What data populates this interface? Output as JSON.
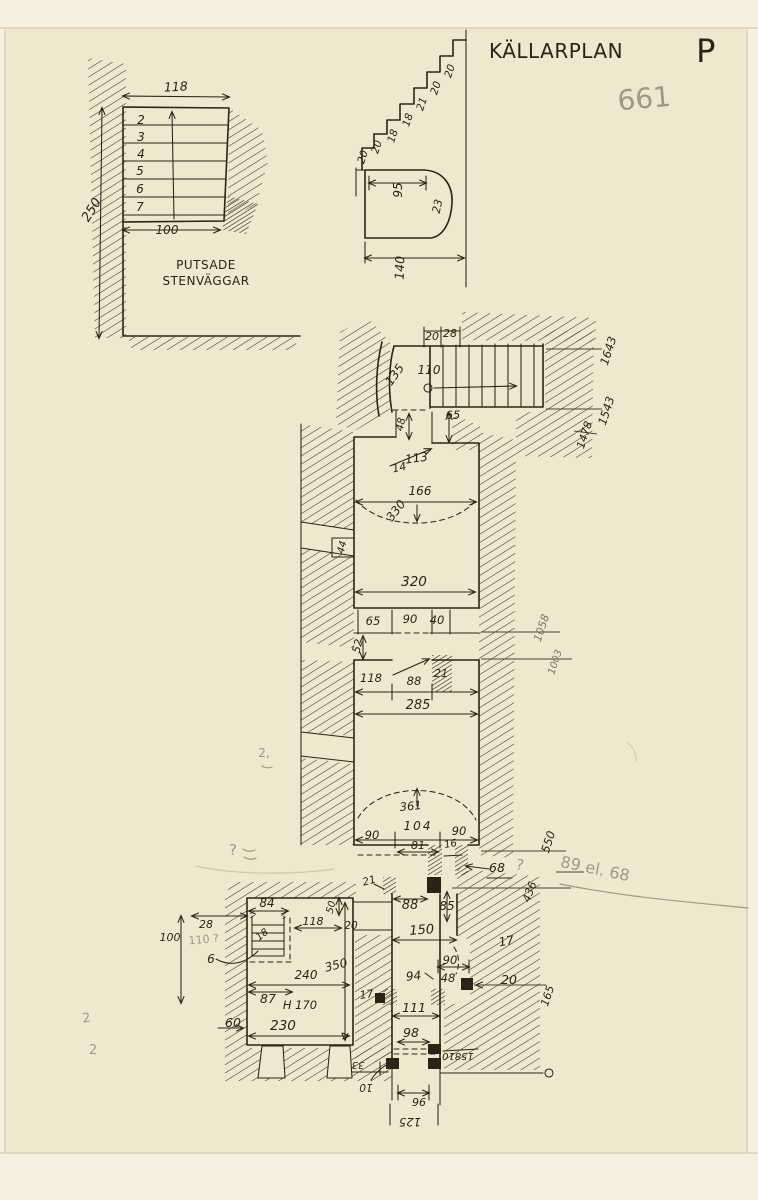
{
  "document": {
    "type": "scanned hand-drawn architectural plan",
    "language": "Swedish"
  },
  "colors": {
    "paper": "#f1e7cf",
    "ink": "#2b2316",
    "pencil": "#a29786"
  },
  "sections": [
    {
      "name": "title-block",
      "labels": [
        {
          "name": "drawing-title",
          "text": "KÄLLARPLAN",
          "x": 556,
          "y": 58,
          "s": 20,
          "sp": 3.5,
          "a": "start",
          "c": "title"
        },
        {
          "name": "drawing-title-plan-letter",
          "text": "P",
          "x": 706,
          "y": 62,
          "s": 32,
          "a": "start",
          "c": "title"
        },
        {
          "name": "archive-number-pencil",
          "text": "661",
          "x": 645,
          "y": 108,
          "s": 28,
          "r": -5,
          "a": "start",
          "c": "pencil"
        }
      ]
    },
    {
      "name": "stair-detail-plan",
      "labels": [
        {
          "name": "dim-width-top",
          "text": "118",
          "x": 176,
          "y": 91,
          "s": 12.5,
          "r": -3
        },
        {
          "name": "step-number",
          "text": "2",
          "x": 141,
          "y": 124,
          "s": 12
        },
        {
          "name": "step-number",
          "text": "3",
          "x": 141,
          "y": 141,
          "s": 12
        },
        {
          "name": "step-number",
          "text": "4",
          "x": 141,
          "y": 158,
          "s": 12
        },
        {
          "name": "step-number",
          "text": "5",
          "x": 140,
          "y": 175,
          "s": 12
        },
        {
          "name": "step-number",
          "text": "6",
          "x": 140,
          "y": 193,
          "s": 12
        },
        {
          "name": "step-number",
          "text": "7",
          "x": 140,
          "y": 211,
          "s": 12
        },
        {
          "name": "dim-height-left",
          "text": "250",
          "x": 95,
          "y": 212,
          "s": 13,
          "r": -58
        },
        {
          "name": "dim-width-bottom",
          "text": "100",
          "x": 167,
          "y": 234,
          "s": 12
        },
        {
          "name": "note-line-1",
          "text": "PUTSADE",
          "x": 206,
          "y": 269,
          "s": 12,
          "sp": 1.5,
          "c": "title"
        },
        {
          "name": "note-line-2",
          "text": "STENVÄGGAR",
          "x": 206,
          "y": 285,
          "s": 12,
          "sp": 1.5,
          "c": "title"
        }
      ]
    },
    {
      "name": "stair-section-detail",
      "labels": [
        {
          "name": "riser-dim",
          "text": "20",
          "x": 453,
          "y": 72,
          "s": 10.5,
          "r": -72
        },
        {
          "name": "riser-dim",
          "text": "20",
          "x": 439,
          "y": 89,
          "s": 10.5,
          "r": -72
        },
        {
          "name": "riser-dim",
          "text": "21",
          "x": 425,
          "y": 105,
          "s": 10.5,
          "r": -72
        },
        {
          "name": "riser-dim",
          "text": "18",
          "x": 411,
          "y": 121,
          "s": 10.5,
          "r": -72
        },
        {
          "name": "riser-dim",
          "text": "18",
          "x": 396,
          "y": 137,
          "s": 10.5,
          "r": -72
        },
        {
          "name": "riser-dim",
          "text": "20",
          "x": 380,
          "y": 148,
          "s": 10.5,
          "r": -72
        },
        {
          "name": "riser-dim",
          "text": "20",
          "x": 366,
          "y": 158,
          "s": 10.5,
          "r": -72
        },
        {
          "name": "arch-width",
          "text": "95",
          "x": 402,
          "y": 190,
          "s": 12,
          "r": -90
        },
        {
          "name": "arch-radius",
          "text": "23",
          "x": 441,
          "y": 207,
          "s": 11,
          "r": -78
        },
        {
          "name": "total-width",
          "text": "140",
          "x": 404,
          "y": 268,
          "s": 12.5,
          "r": -88
        }
      ]
    },
    {
      "name": "upper-stair-flight",
      "labels": [
        {
          "name": "dim",
          "text": "20",
          "x": 432,
          "y": 340,
          "s": 11
        },
        {
          "name": "dim",
          "text": "28",
          "x": 450,
          "y": 337,
          "s": 11
        },
        {
          "name": "dim",
          "text": "135",
          "x": 398,
          "y": 377,
          "s": 12,
          "r": -55
        },
        {
          "name": "dim",
          "text": "110",
          "x": 429,
          "y": 374,
          "s": 12
        },
        {
          "name": "level-mark",
          "text": "1643",
          "x": 612,
          "y": 352,
          "s": 11.5,
          "r": -72
        },
        {
          "name": "level-mark",
          "text": "1543",
          "x": 610,
          "y": 412,
          "s": 11.5,
          "r": -72
        },
        {
          "name": "level-mark",
          "text": "1478",
          "x": 588,
          "y": 436,
          "s": 11,
          "r": -72
        },
        {
          "name": "dim",
          "text": "48",
          "x": 404,
          "y": 425,
          "s": 10.5,
          "r": -78
        },
        {
          "name": "dim",
          "text": "65",
          "x": 453,
          "y": 419,
          "s": 11.5
        },
        {
          "name": "dim",
          "text": "113",
          "x": 417,
          "y": 462,
          "s": 12,
          "r": -8
        },
        {
          "name": "dim",
          "text": "14",
          "x": 400,
          "y": 471,
          "s": 11,
          "r": -12
        }
      ]
    },
    {
      "name": "room-1",
      "labels": [
        {
          "name": "dim",
          "text": "166",
          "x": 420,
          "y": 495,
          "s": 12
        },
        {
          "name": "dim-vault",
          "text": "330",
          "x": 399,
          "y": 513,
          "s": 12,
          "r": -52
        },
        {
          "name": "dim-niche",
          "text": "44",
          "x": 345,
          "y": 548,
          "s": 10,
          "r": -75
        },
        {
          "name": "dim",
          "text": "320",
          "x": 414,
          "y": 586,
          "s": 13.5
        }
      ]
    },
    {
      "name": "door-row",
      "labels": [
        {
          "name": "dim",
          "text": "65",
          "x": 373,
          "y": 625,
          "s": 11.5
        },
        {
          "name": "dim",
          "text": "90",
          "x": 410,
          "y": 623,
          "s": 11.5
        },
        {
          "name": "dim",
          "text": "40",
          "x": 437,
          "y": 624,
          "s": 11.5
        },
        {
          "name": "dim",
          "text": "52",
          "x": 361,
          "y": 647,
          "s": 11,
          "r": -75
        },
        {
          "name": "dim",
          "text": "21",
          "x": 441,
          "y": 677,
          "s": 11
        },
        {
          "name": "dim",
          "text": "118",
          "x": 371,
          "y": 682,
          "s": 11.5
        },
        {
          "name": "dim",
          "text": "88",
          "x": 414,
          "y": 685,
          "s": 11.5
        },
        {
          "name": "dim",
          "text": "285",
          "x": 418,
          "y": 709,
          "s": 13
        },
        {
          "name": "level-mark",
          "text": "1058",
          "x": 545,
          "y": 629,
          "s": 11,
          "r": -72,
          "c": "faint"
        },
        {
          "name": "level-mark",
          "text": "1003",
          "x": 558,
          "y": 663,
          "s": 10,
          "r": -72,
          "c": "faint"
        }
      ]
    },
    {
      "name": "room-2",
      "labels": [
        {
          "name": "dim-vault",
          "text": "361",
          "x": 411,
          "y": 810,
          "s": 11.5,
          "r": -5
        },
        {
          "name": "dim",
          "text": "104",
          "x": 418,
          "y": 830,
          "s": 12,
          "sp": 2
        },
        {
          "name": "dim",
          "text": "90",
          "x": 372,
          "y": 839,
          "s": 11.5
        },
        {
          "name": "dim",
          "text": "90",
          "x": 459,
          "y": 835,
          "s": 11.5
        },
        {
          "name": "dim",
          "text": "81",
          "x": 418,
          "y": 849,
          "s": 11
        },
        {
          "name": "dim",
          "text": "16",
          "x": 451,
          "y": 847,
          "s": 10,
          "r": -10
        },
        {
          "name": "level-mark",
          "text": "550",
          "x": 552,
          "y": 843,
          "s": 11.5,
          "r": -72
        },
        {
          "name": "dim",
          "text": "68",
          "x": 497,
          "y": 872,
          "s": 12.5
        },
        {
          "name": "level-mark",
          "text": "436",
          "x": 533,
          "y": 893,
          "s": 11,
          "r": -70
        },
        {
          "name": "dim",
          "text": "21",
          "x": 370,
          "y": 884,
          "s": 10.5,
          "r": -15
        },
        {
          "name": "dim",
          "text": "88",
          "x": 410,
          "y": 909,
          "s": 13
        },
        {
          "name": "dim",
          "text": "85",
          "x": 447,
          "y": 910,
          "s": 12
        },
        {
          "name": "dim",
          "text": "150",
          "x": 422,
          "y": 934,
          "s": 13,
          "r": -4
        },
        {
          "name": "dim",
          "text": "17",
          "x": 507,
          "y": 945,
          "s": 12,
          "r": -10
        }
      ]
    },
    {
      "name": "left-room",
      "labels": [
        {
          "name": "dim",
          "text": "84",
          "x": 267,
          "y": 907,
          "s": 12
        },
        {
          "name": "dim",
          "text": "28",
          "x": 206,
          "y": 928,
          "s": 11
        },
        {
          "name": "dim",
          "text": "100",
          "x": 170,
          "y": 941,
          "s": 11
        },
        {
          "name": "dim",
          "text": "6",
          "x": 211,
          "y": 963,
          "s": 12
        },
        {
          "name": "dim",
          "text": "18",
          "x": 264,
          "y": 937,
          "s": 10,
          "r": -38
        },
        {
          "name": "dim",
          "text": "118",
          "x": 313,
          "y": 925,
          "s": 11
        },
        {
          "name": "dim",
          "text": "50",
          "x": 334,
          "y": 908,
          "s": 10,
          "r": -75
        },
        {
          "name": "dim",
          "text": "20",
          "x": 351,
          "y": 929,
          "s": 10.5
        },
        {
          "name": "dim",
          "text": "350",
          "x": 337,
          "y": 969,
          "s": 12,
          "r": -14
        },
        {
          "name": "dim",
          "text": "240",
          "x": 306,
          "y": 979,
          "s": 12
        },
        {
          "name": "dim",
          "text": "87",
          "x": 268,
          "y": 1003,
          "s": 12.5
        },
        {
          "name": "dim-height",
          "text": "H 170",
          "x": 300,
          "y": 1009,
          "s": 11.5
        },
        {
          "name": "dim",
          "text": "230",
          "x": 283,
          "y": 1030,
          "s": 13.5
        },
        {
          "name": "dim",
          "text": "60",
          "x": 233,
          "y": 1027,
          "s": 12.5
        },
        {
          "name": "dim",
          "text": "17",
          "x": 367,
          "y": 998,
          "s": 11,
          "r": -8
        }
      ]
    },
    {
      "name": "bottom-passage",
      "labels": [
        {
          "name": "dim",
          "text": "90",
          "x": 450,
          "y": 964,
          "s": 11.5
        },
        {
          "name": "dim",
          "text": "94",
          "x": 414,
          "y": 980,
          "s": 12,
          "r": -6
        },
        {
          "name": "dim",
          "text": "48",
          "x": 448,
          "y": 982,
          "s": 11.5
        },
        {
          "name": "dim",
          "text": "20",
          "x": 509,
          "y": 984,
          "s": 12.5
        },
        {
          "name": "level-mark",
          "text": "165",
          "x": 551,
          "y": 997,
          "s": 11,
          "r": -72
        },
        {
          "name": "dim",
          "text": "111",
          "x": 414,
          "y": 1012,
          "s": 12.5
        },
        {
          "name": "dim",
          "text": "98",
          "x": 411,
          "y": 1037,
          "s": 12.5
        },
        {
          "name": "dim-upside-down",
          "text": "15810",
          "x": 458,
          "y": 1053,
          "s": 10,
          "r": 180
        },
        {
          "name": "dim-upside-down",
          "text": "33",
          "x": 358,
          "y": 1062,
          "s": 10,
          "r": 180
        },
        {
          "name": "dim-upside-down",
          "text": "10",
          "x": 366,
          "y": 1084,
          "s": 10.5,
          "r": 180
        },
        {
          "name": "dim-upside-down",
          "text": "96",
          "x": 419,
          "y": 1098,
          "s": 11,
          "r": 180
        },
        {
          "name": "dim-upside-down",
          "text": "125",
          "x": 410,
          "y": 1118,
          "s": 11.5,
          "r": 180
        }
      ]
    },
    {
      "name": "pencil-annotations",
      "labels": [
        {
          "name": "pencil-note",
          "text": "89 el. 68",
          "x": 594,
          "y": 874,
          "s": 16,
          "r": 12,
          "a": "start",
          "c": "pencil"
        },
        {
          "name": "pencil-question-mark",
          "text": "?",
          "x": 519,
          "y": 870,
          "s": 15,
          "r": 10,
          "c": "pencil"
        },
        {
          "name": "pencil-question-mark",
          "text": "?",
          "x": 233,
          "y": 855,
          "s": 15,
          "c": "pencil"
        },
        {
          "name": "pencil-note",
          "text": "110 ?",
          "x": 204,
          "y": 943,
          "s": 11,
          "r": -5,
          "c": "pencil"
        },
        {
          "name": "pencil-mark",
          "text": "2,",
          "x": 264,
          "y": 757,
          "s": 12,
          "c": "pencil"
        },
        {
          "name": "pencil-mark",
          "text": "2",
          "x": 87,
          "y": 1022,
          "s": 13,
          "r": -8,
          "c": "pencil"
        },
        {
          "name": "pencil-mark",
          "text": "2",
          "x": 93,
          "y": 1054,
          "s": 13,
          "c": "pencil"
        }
      ]
    }
  ]
}
